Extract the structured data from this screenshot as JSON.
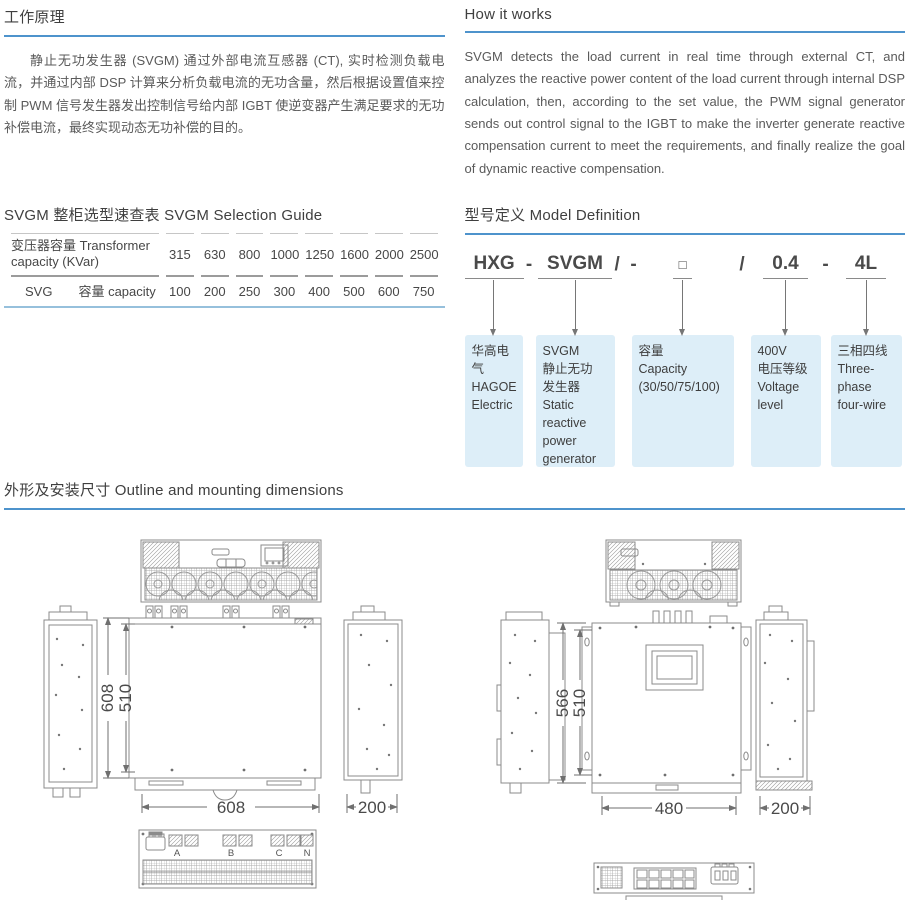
{
  "colors": {
    "accent_blue": "#4e93cc",
    "box_blue": "#ddeef8",
    "heading": "#3f3f3f",
    "body_text": "#5a5a5a",
    "table_rule_blue": "#96c0dc"
  },
  "working_principle": {
    "title": "工作原理",
    "body": "静止无功发生器 (SVGM) 通过外部电流互感器 (CT), 实时检测负载电流，并通过内部 DSP 计算来分析负载电流的无功含量，然后根据设置值来控制 PWM 信号发生器发出控制信号给内部 IGBT 使逆变器产生满足要求的无功补偿电流，最终实现动态无功补偿的目的。"
  },
  "how_it_works": {
    "title": "How it works",
    "body": "SVGM detects the load current in real time through external CT, and analyzes the reactive power content of the load current through internal DSP calculation, then, according to the set value, the PWM signal generator sends out control signal to the IGBT to make the inverter generate reactive compensation current to meet the requirements, and finally realize the goal of dynamic reactive compensation."
  },
  "selection_guide": {
    "title": "SVGM 整柜选型速查表 SVGM Selection Guide",
    "row1_label": "变压器容量 Transformer capacity (KVar)",
    "row1_values": [
      "315",
      "630",
      "800",
      "1000",
      "1250",
      "1600",
      "2000",
      "2500"
    ],
    "row2_label_left": "SVG",
    "row2_label_right": "容量 capacity",
    "row2_values": [
      "100",
      "200",
      "250",
      "300",
      "400",
      "500",
      "600",
      "750"
    ]
  },
  "model_definition": {
    "title": "型号定义 Model Definition",
    "separators": [
      "-",
      "/  -",
      "/",
      "-"
    ],
    "parts": [
      {
        "code": "HXG",
        "desc": "华高电气\nHAGOE\nElectric"
      },
      {
        "code": "SVGM",
        "desc": "SVGM\n静止无功\n发生器\nStatic\nreactive\npower\ngenerator"
      },
      {
        "code": "□",
        "desc": "容量\nCapacity\n(30/50/75/100)"
      },
      {
        "code": "0.4",
        "desc": "400V\n电压等级\nVoltage\nlevel"
      },
      {
        "code": "4L",
        "desc": "三相四线\nThree-\nphase\nfour-wire"
      }
    ]
  },
  "outline": {
    "title": "外形及安装尺寸 Outline and mounting dimensions"
  },
  "figures": {
    "fig1": {
      "dim_height_outer": "608",
      "dim_height_inner": "510",
      "dim_width": "608",
      "dim_depth": "200",
      "terminals": [
        "A",
        "B",
        "C",
        "N"
      ],
      "caption": "图 1  680 模块尺寸图 Figure 1 680 module dimensions"
    },
    "fig2": {
      "dim_height_outer": "566",
      "dim_height_inner": "510",
      "dim_width": "480",
      "dim_depth": "200",
      "caption": "图 2 480 模块尺寸图 Figure 2 480 module dimensions"
    }
  }
}
